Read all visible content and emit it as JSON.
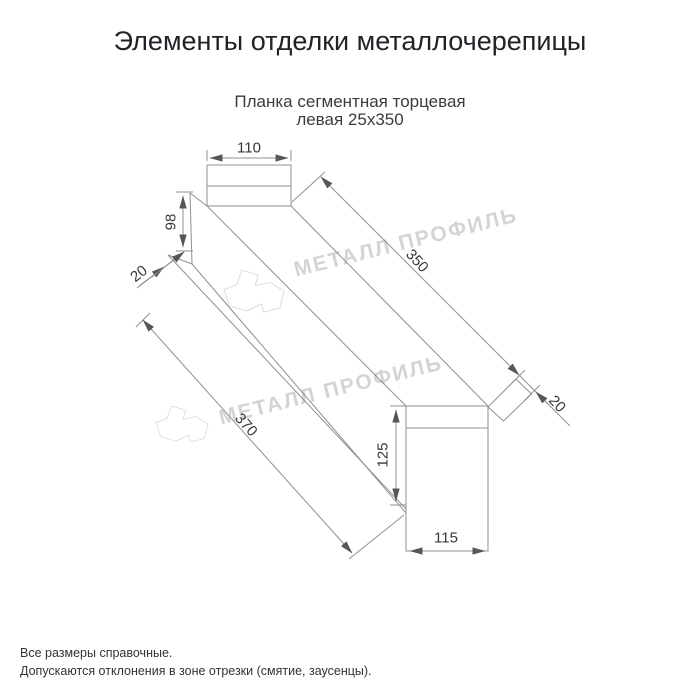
{
  "page": {
    "title": "Элементы отделки металлочерепицы",
    "background": "#ffffff"
  },
  "product": {
    "subtitle_line1": "Планка сегментная торцевая",
    "subtitle_line2": "левая 25х350"
  },
  "drawing": {
    "type": "technical-drawing",
    "line_color": "#8f9094",
    "dimension_text_color": "#38383c",
    "dimensions": {
      "top_segment_width": "110",
      "top_face_height": "98",
      "top_hem": "20",
      "length_upper_edge": "350",
      "length_lower_edge": "370",
      "end_flap": "20",
      "end_segment_height": "125",
      "end_segment_width": "115"
    },
    "watermark": {
      "text": "МЕТАЛЛ ПРОФИЛЬ",
      "color": "#d4d4d6"
    }
  },
  "footer": {
    "line1": "Все размеры справочные.",
    "line2": "Допускаются отклонения в зоне отрезки (смятие, заусенцы)."
  }
}
